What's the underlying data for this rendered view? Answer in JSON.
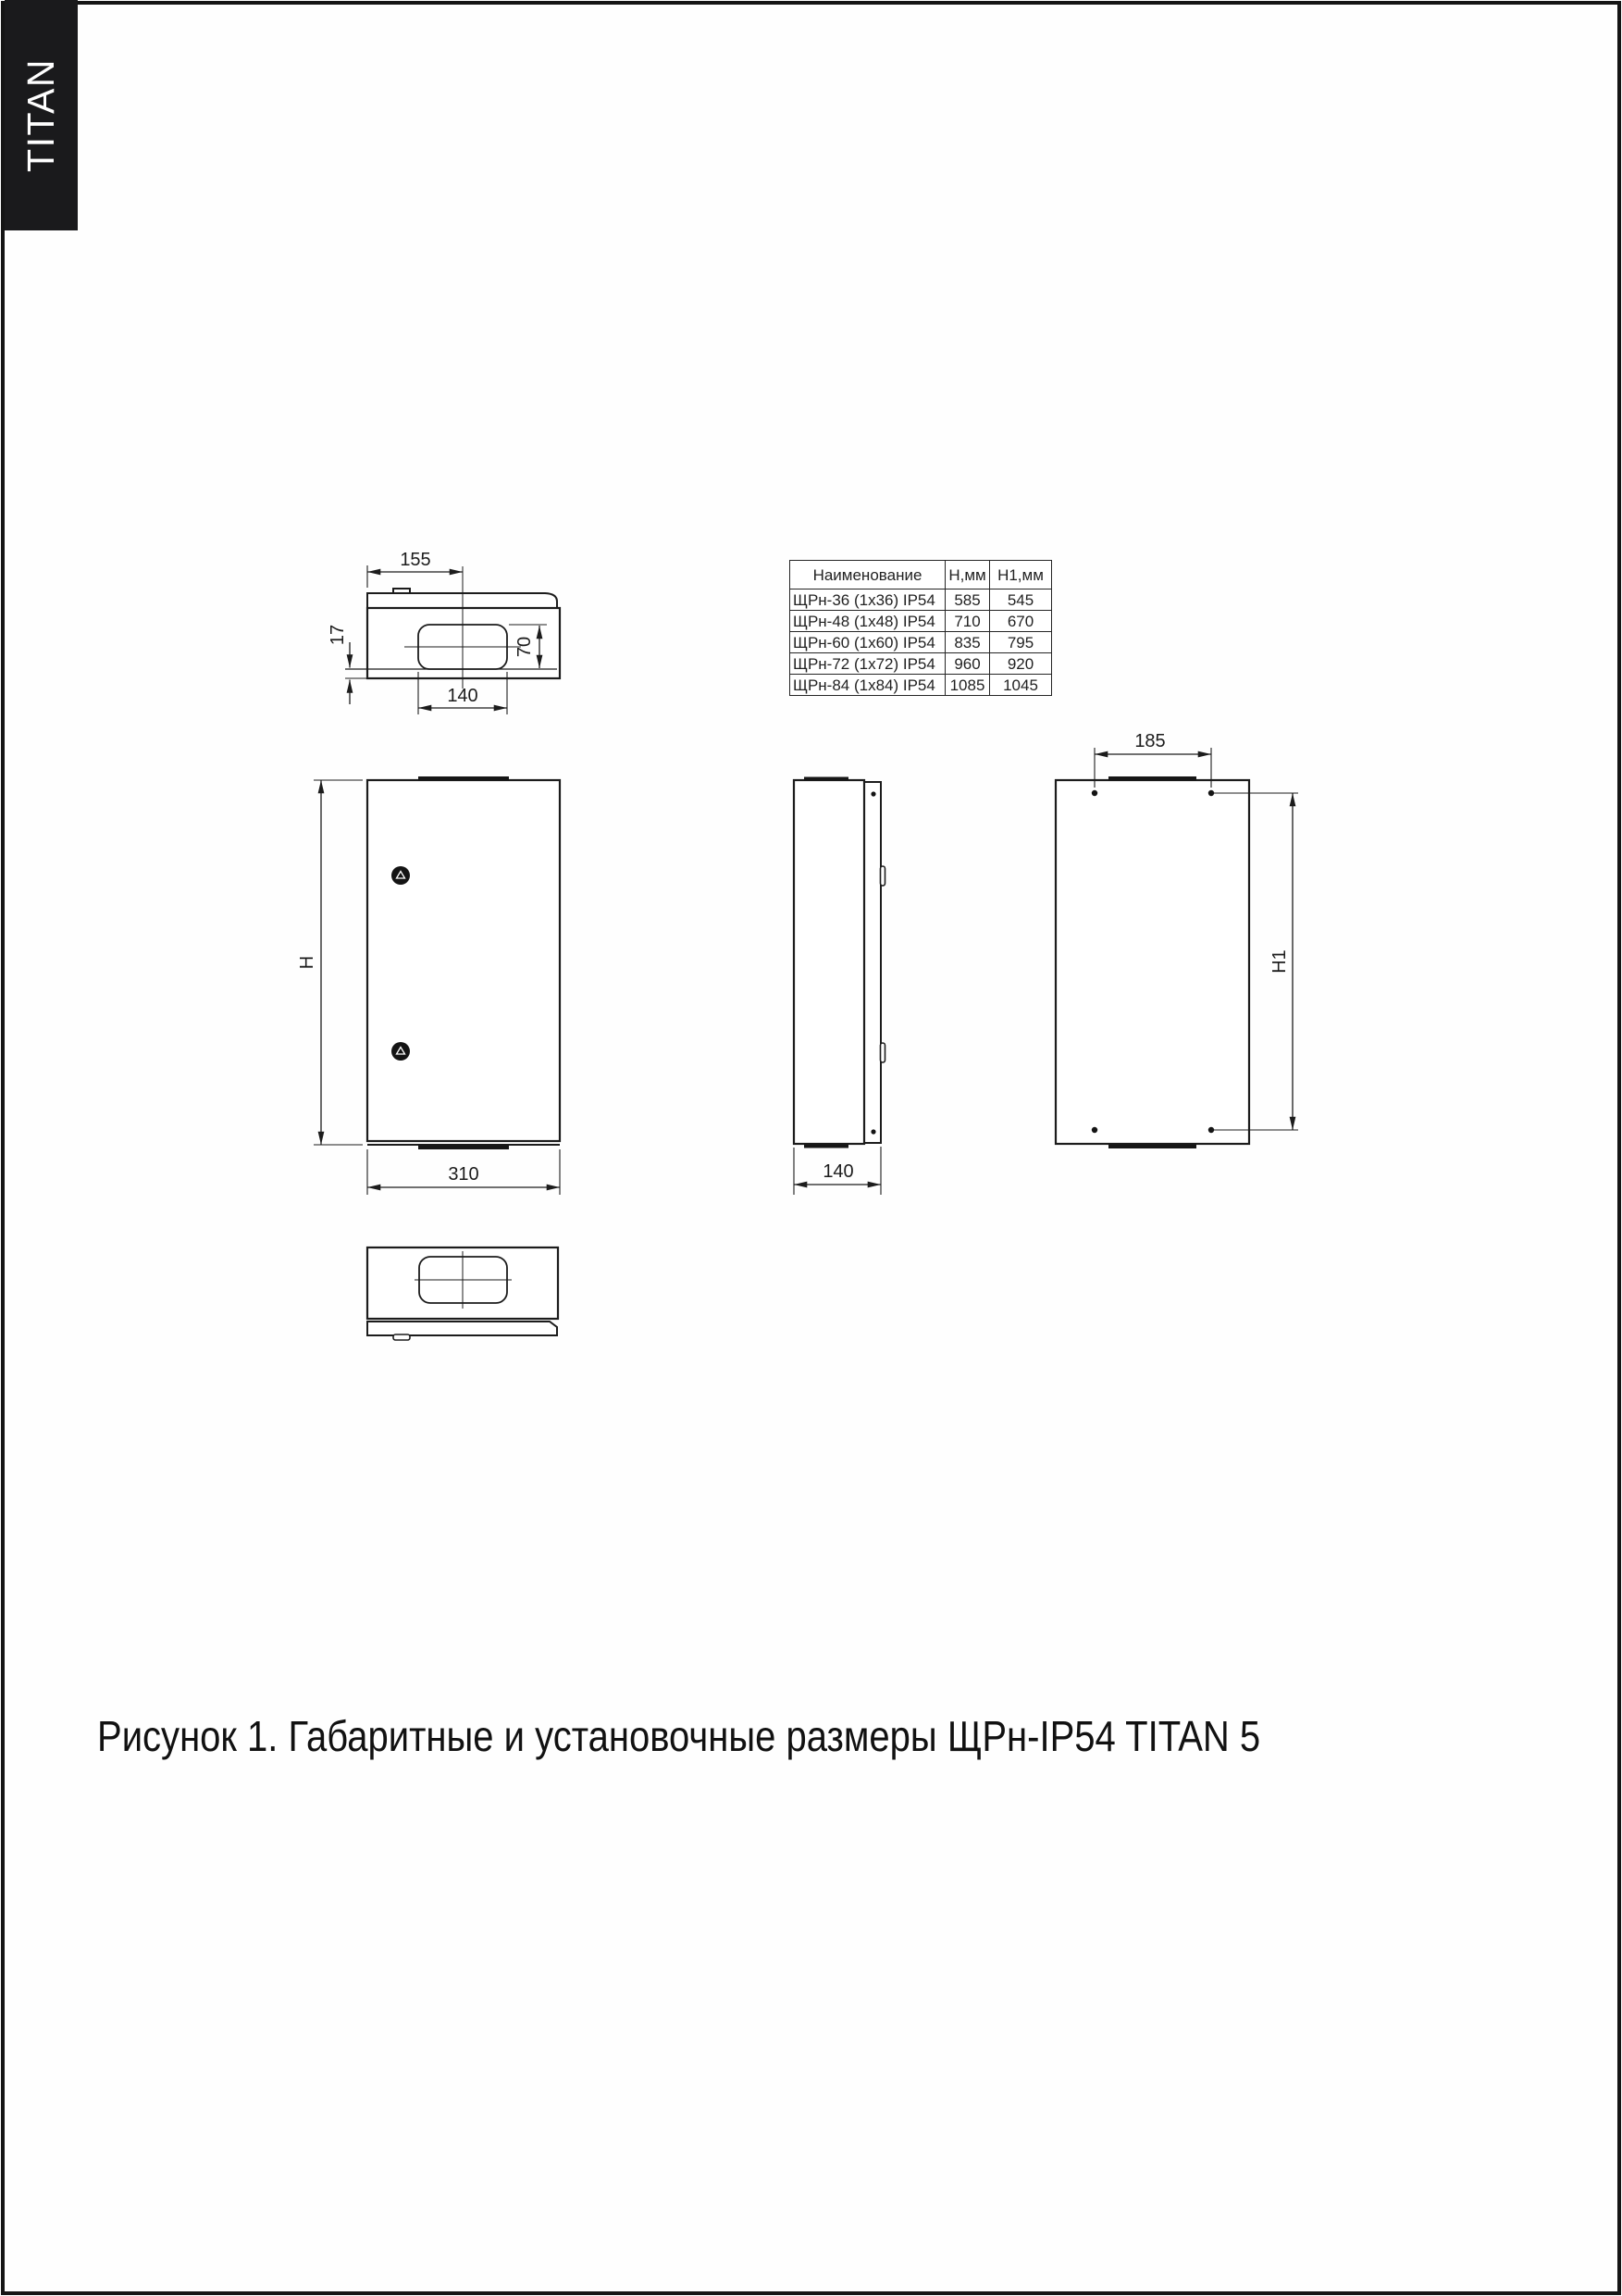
{
  "brand": "TITAN",
  "caption": "Рисунок 1. Габаритные и установочные размеры ЩРн-IP54 TITAN 5",
  "colors": {
    "ink": "#1c1c1c",
    "brand_bg": "#1a1a1c",
    "paper": "#fefefe"
  },
  "table": {
    "headers": {
      "name": "Наименование",
      "h": "Н,мм",
      "h1": "Н1,мм"
    },
    "rows": [
      {
        "name": "ЩРн-36 (1х36) IP54",
        "h": "585",
        "h1": "545"
      },
      {
        "name": "ЩРн-48 (1х48) IP54",
        "h": "710",
        "h1": "670"
      },
      {
        "name": "ЩРн-60 (1х60) IP54",
        "h": "835",
        "h1": "795"
      },
      {
        "name": "ЩРн-72 (1х72) IP54",
        "h": "960",
        "h1": "920"
      },
      {
        "name": "ЩРн-84 (1х84) IP54",
        "h": "1085",
        "h1": "1045"
      }
    ]
  },
  "dims": {
    "top": {
      "left_to_center": "155",
      "plate_offset": "17",
      "cutout_height": "70",
      "cutout_width": "140"
    },
    "front": {
      "height": "H",
      "width": "310"
    },
    "side": {
      "depth": "140"
    },
    "rear": {
      "hole_spacing_x": "185",
      "hole_spacing_y": "H1"
    }
  }
}
